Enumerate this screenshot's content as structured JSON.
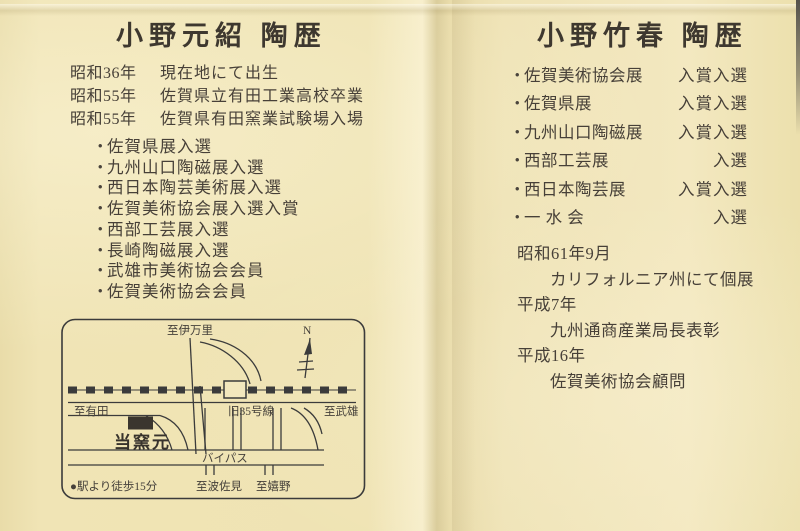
{
  "bullet": "・",
  "colors": {
    "paper": "#f1e5b8",
    "ink": "#474038",
    "line": "#3b3b3b"
  },
  "page_left": {
    "title": "小野元紹 陶歴",
    "history": [
      {
        "year": "昭和36年",
        "event": "現在地にて出生"
      },
      {
        "year": "昭和55年",
        "event": "佐賀県立有田工業高校卒業"
      },
      {
        "year": "昭和55年",
        "event": "佐賀県有田窯業試験場入場"
      }
    ],
    "awards": [
      "佐賀県展入選",
      "九州山口陶磁展入選",
      "西日本陶芸美術展入選",
      "佐賀美術協会展入選入賞",
      "西部工芸展入選",
      "長崎陶磁展入選",
      "武雄市美術協会会員",
      "佐賀美術協会会員"
    ],
    "map": {
      "north": "N",
      "to_imari": "至伊万里",
      "to_arita": "至有田",
      "route_label": "旧35号線",
      "to_takeo": "至武雄",
      "kiln_label": "当窯元",
      "bypass_label": "バイパス",
      "to_hasami": "至波佐見",
      "to_ureshino": "至嬉野",
      "walk_note": "●駅より徒歩15分"
    }
  },
  "page_right": {
    "title": "小野竹春 陶歴",
    "awards": [
      {
        "name": "佐賀美術協会展",
        "result": "入賞入選"
      },
      {
        "name": "佐賀県展",
        "result": "入賞入選"
      },
      {
        "name": "九州山口陶磁展",
        "result": "入賞入選"
      },
      {
        "name": "西部工芸展",
        "result": "入選"
      },
      {
        "name": "西日本陶芸展",
        "result": "入賞入選"
      },
      {
        "name": "一 水 会",
        "result": "入選"
      }
    ],
    "timeline": [
      {
        "year": "昭和61年9月",
        "event": "カリフォルニア州にて個展"
      },
      {
        "year": "平成7年",
        "event": "九州通商産業局長表彰"
      },
      {
        "year": "平成16年",
        "event": "佐賀美術協会顧問"
      }
    ]
  }
}
